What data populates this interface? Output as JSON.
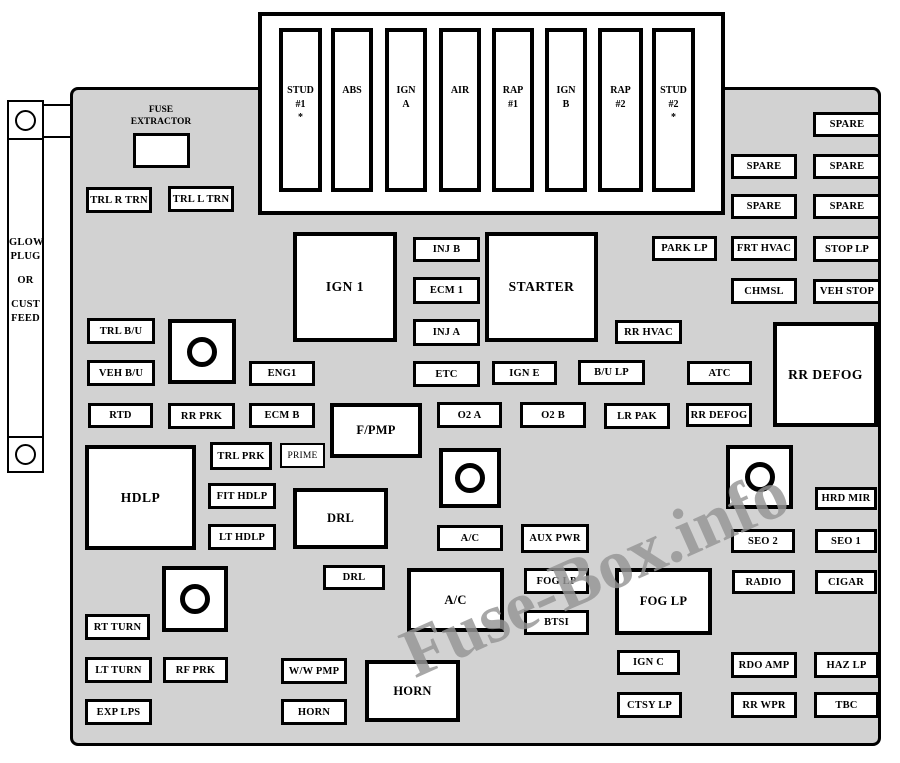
{
  "diagram": {
    "watermark": "Fuse-Box.info",
    "colors": {
      "panel_bg": "#d2d2d2",
      "box_fill": "#ffffff",
      "box_border": "#000000",
      "watermark": "#969696"
    }
  },
  "left_strip": {
    "lines": [
      "GLOW",
      "PLUG",
      "",
      "OR",
      "",
      "CUST",
      "FEED"
    ]
  },
  "fuse_extractor": {
    "lines": [
      "FUSE",
      "EXTRACTOR"
    ]
  },
  "top_slots": [
    {
      "lines": [
        "STUD",
        "#1",
        "*"
      ],
      "x": 279,
      "y": 28,
      "w": 43,
      "h": 164
    },
    {
      "lines": [
        "ABS"
      ],
      "x": 331,
      "y": 28,
      "w": 42,
      "h": 164
    },
    {
      "lines": [
        "IGN",
        "A"
      ],
      "x": 385,
      "y": 28,
      "w": 42,
      "h": 164
    },
    {
      "lines": [
        "AIR"
      ],
      "x": 439,
      "y": 28,
      "w": 42,
      "h": 164
    },
    {
      "lines": [
        "RAP",
        "#1"
      ],
      "x": 492,
      "y": 28,
      "w": 42,
      "h": 164
    },
    {
      "lines": [
        "IGN",
        "B"
      ],
      "x": 545,
      "y": 28,
      "w": 42,
      "h": 164
    },
    {
      "lines": [
        "RAP",
        "#2"
      ],
      "x": 598,
      "y": 28,
      "w": 45,
      "h": 164
    },
    {
      "lines": [
        "STUD",
        "#2",
        "*"
      ],
      "x": 652,
      "y": 28,
      "w": 43,
      "h": 164
    }
  ],
  "fuses": [
    {
      "label": "TRL R TRN",
      "x": 86,
      "y": 187,
      "w": 66,
      "h": 26,
      "kind": "s"
    },
    {
      "label": "TRL L TRN",
      "x": 168,
      "y": 186,
      "w": 66,
      "h": 26,
      "kind": "s"
    },
    {
      "label": "SPARE",
      "x": 813,
      "y": 112,
      "w": 68,
      "h": 25,
      "kind": "s"
    },
    {
      "label": "SPARE",
      "x": 731,
      "y": 154,
      "w": 66,
      "h": 25,
      "kind": "s"
    },
    {
      "label": "SPARE",
      "x": 813,
      "y": 154,
      "w": 68,
      "h": 25,
      "kind": "s"
    },
    {
      "label": "SPARE",
      "x": 731,
      "y": 194,
      "w": 66,
      "h": 25,
      "kind": "s"
    },
    {
      "label": "SPARE",
      "x": 813,
      "y": 194,
      "w": 68,
      "h": 25,
      "kind": "s"
    },
    {
      "label": "PARK LP",
      "x": 652,
      "y": 236,
      "w": 65,
      "h": 25,
      "kind": "s"
    },
    {
      "label": "FRT HVAC",
      "x": 731,
      "y": 236,
      "w": 66,
      "h": 25,
      "kind": "s"
    },
    {
      "label": "STOP LP",
      "x": 813,
      "y": 236,
      "w": 68,
      "h": 26,
      "kind": "s"
    },
    {
      "label": "CHMSL",
      "x": 731,
      "y": 278,
      "w": 66,
      "h": 26,
      "kind": "s"
    },
    {
      "label": "VEH STOP",
      "x": 813,
      "y": 279,
      "w": 68,
      "h": 25,
      "kind": "s"
    },
    {
      "label": "IGN 1",
      "x": 293,
      "y": 232,
      "w": 104,
      "h": 110,
      "kind": "l"
    },
    {
      "label": "STARTER",
      "x": 485,
      "y": 232,
      "w": 113,
      "h": 110,
      "kind": "l"
    },
    {
      "label": "INJ B",
      "x": 413,
      "y": 237,
      "w": 67,
      "h": 25,
      "kind": "s"
    },
    {
      "label": "ECM 1",
      "x": 413,
      "y": 277,
      "w": 67,
      "h": 27,
      "kind": "s"
    },
    {
      "label": "INJ A",
      "x": 413,
      "y": 319,
      "w": 67,
      "h": 27,
      "kind": "s"
    },
    {
      "label": "RR HVAC",
      "x": 615,
      "y": 320,
      "w": 67,
      "h": 24,
      "kind": "s"
    },
    {
      "label": "TRL B/U",
      "x": 87,
      "y": 318,
      "w": 68,
      "h": 26,
      "kind": "s"
    },
    {
      "label": "ENG1",
      "x": 249,
      "y": 361,
      "w": 66,
      "h": 25,
      "kind": "s"
    },
    {
      "label": "VEH B/U",
      "x": 87,
      "y": 360,
      "w": 68,
      "h": 26,
      "kind": "s"
    },
    {
      "label": "ETC",
      "x": 413,
      "y": 361,
      "w": 67,
      "h": 26,
      "kind": "s"
    },
    {
      "label": "IGN E",
      "x": 492,
      "y": 361,
      "w": 65,
      "h": 24,
      "kind": "s"
    },
    {
      "label": "B/U LP",
      "x": 578,
      "y": 360,
      "w": 67,
      "h": 25,
      "kind": "s"
    },
    {
      "label": "ATC",
      "x": 687,
      "y": 361,
      "w": 65,
      "h": 24,
      "kind": "s"
    },
    {
      "label": "RR DEFOG",
      "x": 773,
      "y": 322,
      "w": 105,
      "h": 105,
      "kind": "l"
    },
    {
      "label": "RTD",
      "x": 88,
      "y": 403,
      "w": 65,
      "h": 25,
      "kind": "s"
    },
    {
      "label": "RR PRK",
      "x": 168,
      "y": 403,
      "w": 67,
      "h": 26,
      "kind": "s"
    },
    {
      "label": "ECM B",
      "x": 249,
      "y": 403,
      "w": 66,
      "h": 25,
      "kind": "s"
    },
    {
      "label": "F/PMP",
      "x": 330,
      "y": 403,
      "w": 92,
      "h": 55,
      "kind": "m"
    },
    {
      "label": "O2 A",
      "x": 437,
      "y": 402,
      "w": 65,
      "h": 26,
      "kind": "s"
    },
    {
      "label": "O2 B",
      "x": 520,
      "y": 402,
      "w": 66,
      "h": 26,
      "kind": "s"
    },
    {
      "label": "LR PAK",
      "x": 604,
      "y": 403,
      "w": 66,
      "h": 26,
      "kind": "s"
    },
    {
      "label": "RR DEFOG",
      "x": 686,
      "y": 403,
      "w": 66,
      "h": 24,
      "kind": "s"
    },
    {
      "label": "TRL PRK",
      "x": 210,
      "y": 442,
      "w": 62,
      "h": 28,
      "kind": "s"
    },
    {
      "label": "PRIME",
      "x": 280,
      "y": 443,
      "w": 45,
      "h": 25,
      "kind": "thin"
    },
    {
      "label": "HDLP",
      "x": 85,
      "y": 445,
      "w": 111,
      "h": 105,
      "kind": "l"
    },
    {
      "label": "FIT HDLP",
      "x": 208,
      "y": 483,
      "w": 68,
      "h": 26,
      "kind": "s"
    },
    {
      "label": "LT HDLP",
      "x": 208,
      "y": 524,
      "w": 68,
      "h": 26,
      "kind": "s"
    },
    {
      "label": "DRL",
      "x": 293,
      "y": 488,
      "w": 95,
      "h": 61,
      "kind": "m"
    },
    {
      "label": "A/C",
      "x": 437,
      "y": 525,
      "w": 66,
      "h": 26,
      "kind": "s"
    },
    {
      "label": "AUX PWR",
      "x": 521,
      "y": 524,
      "w": 68,
      "h": 29,
      "kind": "s"
    },
    {
      "label": "HRD MIR",
      "x": 815,
      "y": 487,
      "w": 62,
      "h": 23,
      "kind": "s"
    },
    {
      "label": "SEO 2",
      "x": 731,
      "y": 529,
      "w": 64,
      "h": 24,
      "kind": "s"
    },
    {
      "label": "SEO 1",
      "x": 815,
      "y": 529,
      "w": 62,
      "h": 24,
      "kind": "s"
    },
    {
      "label": "RADIO",
      "x": 732,
      "y": 570,
      "w": 63,
      "h": 24,
      "kind": "s"
    },
    {
      "label": "CIGAR",
      "x": 815,
      "y": 570,
      "w": 62,
      "h": 24,
      "kind": "s"
    },
    {
      "label": "DRL",
      "x": 323,
      "y": 565,
      "w": 62,
      "h": 25,
      "kind": "s"
    },
    {
      "label": "FOG LP",
      "x": 524,
      "y": 568,
      "w": 65,
      "h": 26,
      "kind": "s"
    },
    {
      "label": "A/C",
      "x": 407,
      "y": 568,
      "w": 97,
      "h": 64,
      "kind": "m"
    },
    {
      "label": "FOG LP",
      "x": 615,
      "y": 568,
      "w": 97,
      "h": 67,
      "kind": "m"
    },
    {
      "label": "BTSI",
      "x": 524,
      "y": 610,
      "w": 65,
      "h": 25,
      "kind": "s"
    },
    {
      "label": "RT TURN",
      "x": 85,
      "y": 614,
      "w": 65,
      "h": 26,
      "kind": "s"
    },
    {
      "label": "LT TURN",
      "x": 85,
      "y": 657,
      "w": 67,
      "h": 26,
      "kind": "s"
    },
    {
      "label": "RF PRK",
      "x": 163,
      "y": 657,
      "w": 65,
      "h": 26,
      "kind": "s"
    },
    {
      "label": "W/W PMP",
      "x": 281,
      "y": 658,
      "w": 66,
      "h": 26,
      "kind": "s"
    },
    {
      "label": "EXP LPS",
      "x": 85,
      "y": 699,
      "w": 67,
      "h": 26,
      "kind": "s"
    },
    {
      "label": "HORN",
      "x": 281,
      "y": 699,
      "w": 66,
      "h": 26,
      "kind": "s"
    },
    {
      "label": "HORN",
      "x": 365,
      "y": 660,
      "w": 95,
      "h": 62,
      "kind": "m"
    },
    {
      "label": "IGN C",
      "x": 617,
      "y": 650,
      "w": 63,
      "h": 25,
      "kind": "s"
    },
    {
      "label": "CTSY LP",
      "x": 617,
      "y": 692,
      "w": 65,
      "h": 26,
      "kind": "s"
    },
    {
      "label": "RDO AMP",
      "x": 731,
      "y": 652,
      "w": 66,
      "h": 26,
      "kind": "s"
    },
    {
      "label": "HAZ LP",
      "x": 814,
      "y": 652,
      "w": 65,
      "h": 26,
      "kind": "s"
    },
    {
      "label": "RR WPR",
      "x": 731,
      "y": 692,
      "w": 66,
      "h": 26,
      "kind": "s"
    },
    {
      "label": "TBC",
      "x": 814,
      "y": 692,
      "w": 65,
      "h": 26,
      "kind": "s"
    }
  ],
  "relays": [
    {
      "x": 168,
      "y": 319,
      "w": 68,
      "h": 65
    },
    {
      "x": 439,
      "y": 448,
      "w": 62,
      "h": 60
    },
    {
      "x": 726,
      "y": 445,
      "w": 67,
      "h": 64
    },
    {
      "x": 162,
      "y": 566,
      "w": 66,
      "h": 66
    }
  ]
}
